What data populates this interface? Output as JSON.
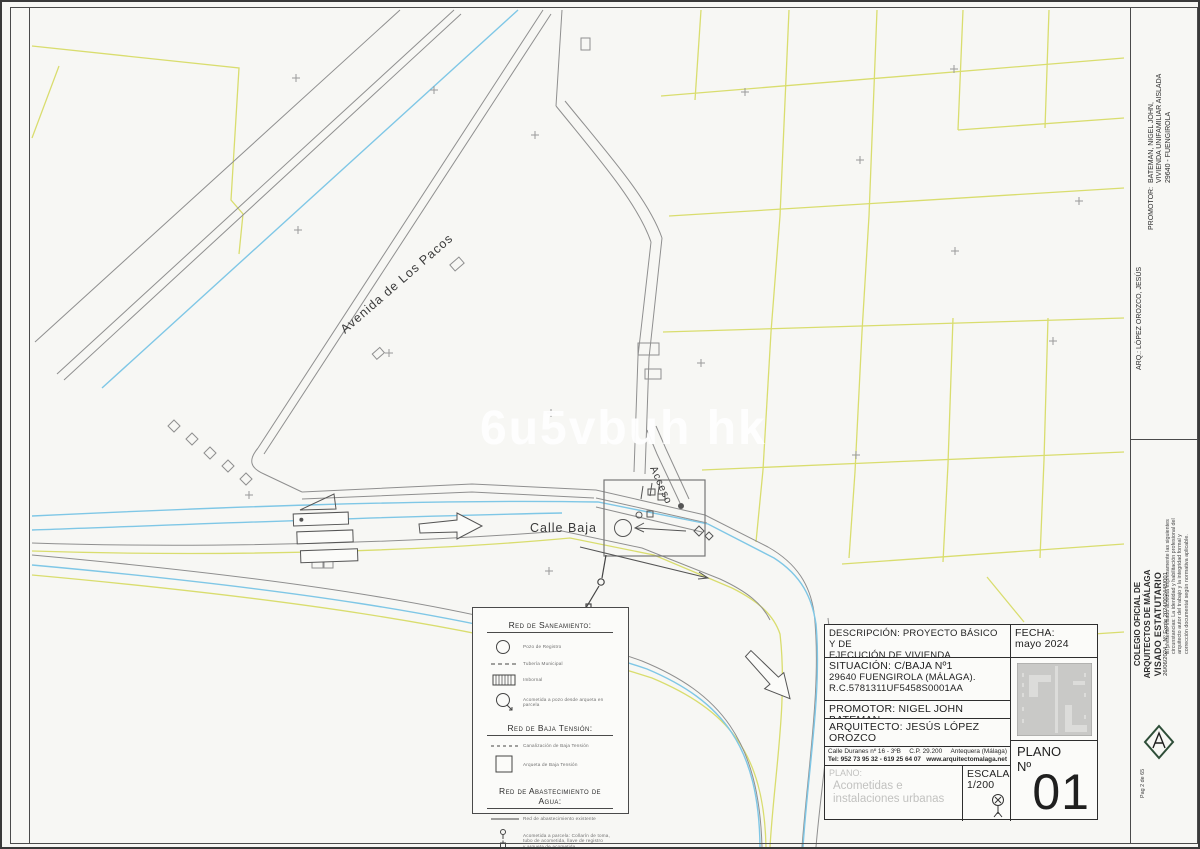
{
  "colors": {
    "water": "#7fc7e6",
    "parcel": "#d9dd6e",
    "road_line": "#8f8f8f",
    "watermark": "#ffffff"
  },
  "map": {
    "watermark": "6u5vbuh hk",
    "labels": {
      "avenue": "Avenida de Los Pacos",
      "street": "Calle Baja",
      "access": "Acceso"
    }
  },
  "legend": {
    "sections": [
      {
        "title": "Red de Saneamiento:",
        "items": [
          {
            "symbol": "circle-icon",
            "label": "Pozo de Registro"
          },
          {
            "symbol": "dashed-line-icon",
            "label": "Tubería Municipal"
          },
          {
            "symbol": "hatched-rect-icon",
            "label": "Imbornal"
          },
          {
            "symbol": "circle-arrow-icon",
            "label": "Acometida a pozo desde arqueta en parcela"
          }
        ]
      },
      {
        "title": "Red de Baja Tensión:",
        "items": [
          {
            "symbol": "dashed-line-icon",
            "label": "Canalización de Baja Tensión"
          },
          {
            "symbol": "square-icon",
            "label": "Arqueta de Baja Tensión"
          }
        ]
      },
      {
        "title": "Red de Abastecimiento de Agua:",
        "items": [
          {
            "symbol": "solid-line-icon",
            "label": "Red de abastecimiento existente"
          },
          {
            "symbol": "hydrant-icon",
            "label_lines": [
              "Acometida a parcela: Collarín de toma,",
              "tubo de acometida, llave de registro",
              "y arqueta de acometida"
            ]
          }
        ]
      }
    ]
  },
  "title_block": {
    "desc_lines": [
      "DESCRIPCIÓN: PROYECTO BÁSICO Y DE",
      "EJECUCIÓN DE VIVIENDA UNIFAMILIAR",
      "AISLADA CON PISCINA"
    ],
    "fecha_label": "FECHA:",
    "fecha_value": "mayo 2024",
    "situ_lines": [
      "SITUACIÓN:  C/BAJA Nº1",
      "29640 FUENGIROLA (MÁLAGA).",
      "R.C.5781311UF5458S0001AA"
    ],
    "promotor": "PROMOTOR: NIGEL JOHN BATEMAN",
    "arquitecto": "ARQUITECTO: JESÚS LÓPEZ OROZCO",
    "addr_street": "Calle Duranes nº 16 - 3ºB",
    "addr_cp": "C.P. 29.200",
    "addr_city": "Antequera (Málaga)",
    "addr_tel": "Tel: 952 73 95 32 - 619 25 64 07",
    "addr_web": "www.arquitectomalaga.net",
    "plano_label": "PLANO:",
    "plano_lines": [
      "Acometidas e",
      "instalaciones urbanas"
    ],
    "escala_label": "ESCALA:",
    "escala_value": "1/200",
    "num_label_1": "PLANO",
    "num_label_2": "Nº",
    "num_value": "01"
  },
  "sidebar": {
    "promotor_label": "PROMOTOR:",
    "promotor_lines": [
      "BATEMAN, NIGEL JOHN,",
      "VIVIENDA UNIFAMILIAR AISLADA",
      "29640 - FUENGIROLA"
    ],
    "arq": "ARQ.: LÓPEZ OROZCO, JESÚS",
    "visado_note_lines": [
      "El presente visado acredita expresamente las siguientes",
      "circunstancias: La identidad y habilitación profesional del",
      "arquitecto autor del trabajo y la integridad formal y",
      "corrección documental según normativa aplicable."
    ],
    "visado_title": "VISADO ESTATUTARIO",
    "visado_expte": "26/06/2024 - Nº Expte 2024/002448/001",
    "colegio_lines": [
      "COLEGIO OFICIAL DE",
      "ARQUITECTOS DE MÁLAGA"
    ],
    "page_note": "Pag 2 de 65"
  }
}
